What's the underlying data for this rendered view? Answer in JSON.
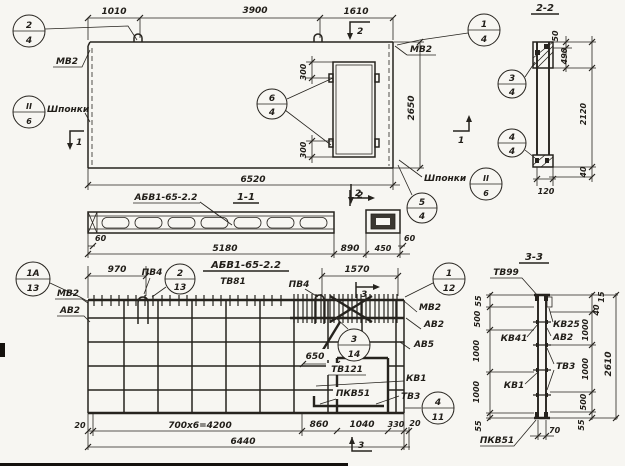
{
  "colors": {
    "ink": "#26231e",
    "paper": "#f7f6f2"
  },
  "top_plan": {
    "dim_1010": "1010",
    "dim_3900": "3900",
    "dim_1610": "1610",
    "dim_300_top": "300",
    "dim_300_bottom": "300",
    "dim_2650": "2650",
    "dim_6520": "6520",
    "label_mv2_left": "МВ2",
    "label_mv2_right": "МВ2",
    "label_shponki_left": "Шпонки",
    "label_shponki_right": "Шпонки",
    "marker_2_top": "2",
    "marker_2_bottom": "2",
    "marker_1_left": "1",
    "marker_1_right": "1",
    "callout_2_4": {
      "num": "2",
      "den": "4"
    },
    "callout_1_4": {
      "num": "1",
      "den": "4"
    },
    "callout_6_4": {
      "num": "6",
      "den": "4"
    },
    "callout_ii_6_left": {
      "num": "II",
      "den": "6"
    },
    "callout_ii_6_right": {
      "num": "II",
      "den": "6"
    },
    "callout_5_4": {
      "num": "5",
      "den": "4"
    }
  },
  "section_2_2": {
    "title": "2-2",
    "dim_50": "50",
    "dim_490": "490",
    "dim_2120": "2120",
    "dim_40": "40",
    "dim_120": "120",
    "callout_3_4": {
      "num": "3",
      "den": "4"
    },
    "callout_4_4": {
      "num": "4",
      "den": "4"
    }
  },
  "section_1_1": {
    "title": "1-1",
    "mark_label": "АБВ1-65-2.2",
    "marker_2": "2",
    "dim_60_left": "60",
    "dim_5180": "5180",
    "dim_890": "890",
    "dim_450": "450",
    "dim_60_right": "60"
  },
  "rebar_plan": {
    "title": "АБВ1-65-2.2",
    "subtitle": "ТВ81",
    "dim_970": "970",
    "dim_1570": "1570",
    "dim_650": "650",
    "label_pv4_left": "ПВ4",
    "label_pv4_right": "ПВ4",
    "label_mv2_left": "МВ2",
    "label_av2_left": "АВ2",
    "label_mv2_right": "МВ2",
    "label_av2_right": "АВ2",
    "label_av5": "АВ5",
    "label_tv121": "ТВ121",
    "label_kv1": "КВ1",
    "label_pkv51": "ПКВ51",
    "label_tv3": "ТВ3",
    "marker_3_top": "3",
    "marker_3_bottom": "3",
    "callout_1a_13": {
      "num": "1А",
      "den": "13"
    },
    "callout_2_13": {
      "num": "2",
      "den": "13"
    },
    "callout_3_14": {
      "num": "3",
      "den": "14"
    },
    "callout_1_12": {
      "num": "1",
      "den": "12"
    },
    "callout_4_11": {
      "num": "4",
      "den": "11"
    },
    "dim_20_left": "20",
    "dim_700x6": "700x6=4200",
    "dim_860": "860",
    "dim_1040": "1040",
    "dim_330": "330",
    "dim_20_right": "20",
    "dim_6440": "6440"
  },
  "section_3_3": {
    "title": "3-3",
    "label_tv99": "ТВ99",
    "label_kv41": "КВ41",
    "label_kv1": "КВ1",
    "label_pkv51": "ПКВ51",
    "label_kv25": "КВ25",
    "label_av2": "АВ2",
    "label_tv3": "ТВ3",
    "left_dims": [
      "55",
      "500",
      "1000",
      "1000",
      "55"
    ],
    "right_dims": [
      "15",
      "40",
      "1000",
      "1000",
      "500",
      "55"
    ],
    "dim_2610": "2610",
    "dim_70": "70"
  }
}
